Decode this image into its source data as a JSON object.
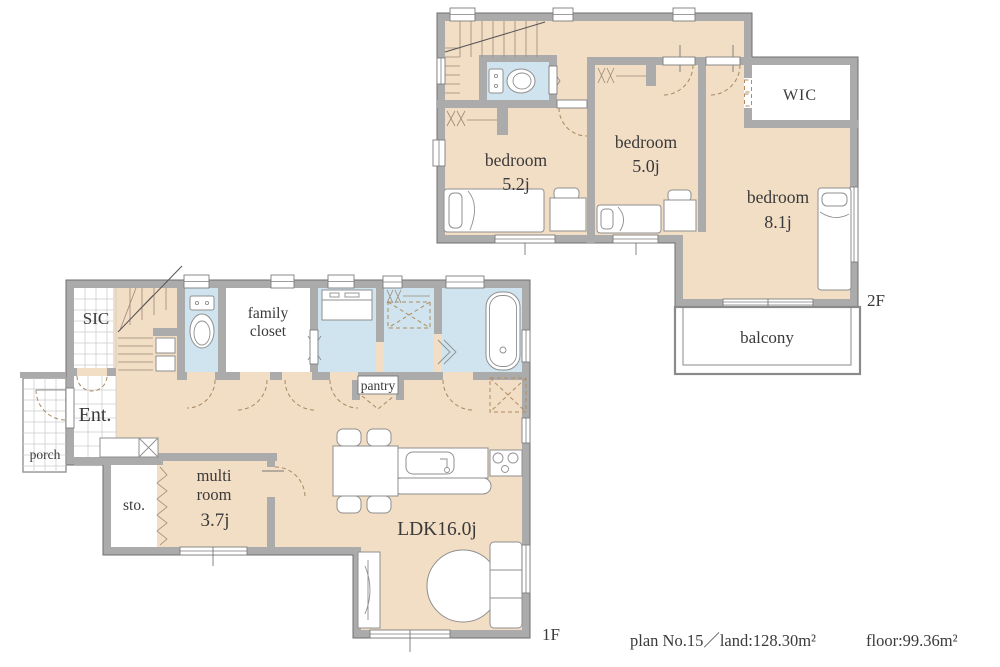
{
  "colors": {
    "room_fill": "#f2ddc5",
    "wet_fill": "#cfe4ef",
    "wall_fill": "#ababab",
    "door_dash": "#a58b63",
    "text": "#3a3a3a"
  },
  "floor2": {
    "floor_label": "2F",
    "bedroom_52": {
      "name": "bedroom",
      "size": "5.2j"
    },
    "bedroom_50": {
      "name": "bedroom",
      "size": "5.0j"
    },
    "bedroom_81": {
      "name": "bedroom",
      "size": "8.1j"
    },
    "wic": {
      "label": "WIC"
    },
    "balcony": {
      "label": "balcony"
    }
  },
  "floor1": {
    "floor_label": "1F",
    "sic": {
      "label": "SIC"
    },
    "entrance": {
      "label": "Ent."
    },
    "porch": {
      "label": "porch"
    },
    "family_closet": {
      "line1": "family",
      "line2": "closet"
    },
    "pantry": {
      "label": "pantry"
    },
    "storage": {
      "label": "sto."
    },
    "multi_room": {
      "line1": "multi",
      "line2": "room",
      "size": "3.7j"
    },
    "ldk": {
      "label": "LDK16.0j"
    }
  },
  "footer": {
    "plan": "plan No.15／land:128.30m²",
    "floor_area": "floor:99.36m²"
  }
}
